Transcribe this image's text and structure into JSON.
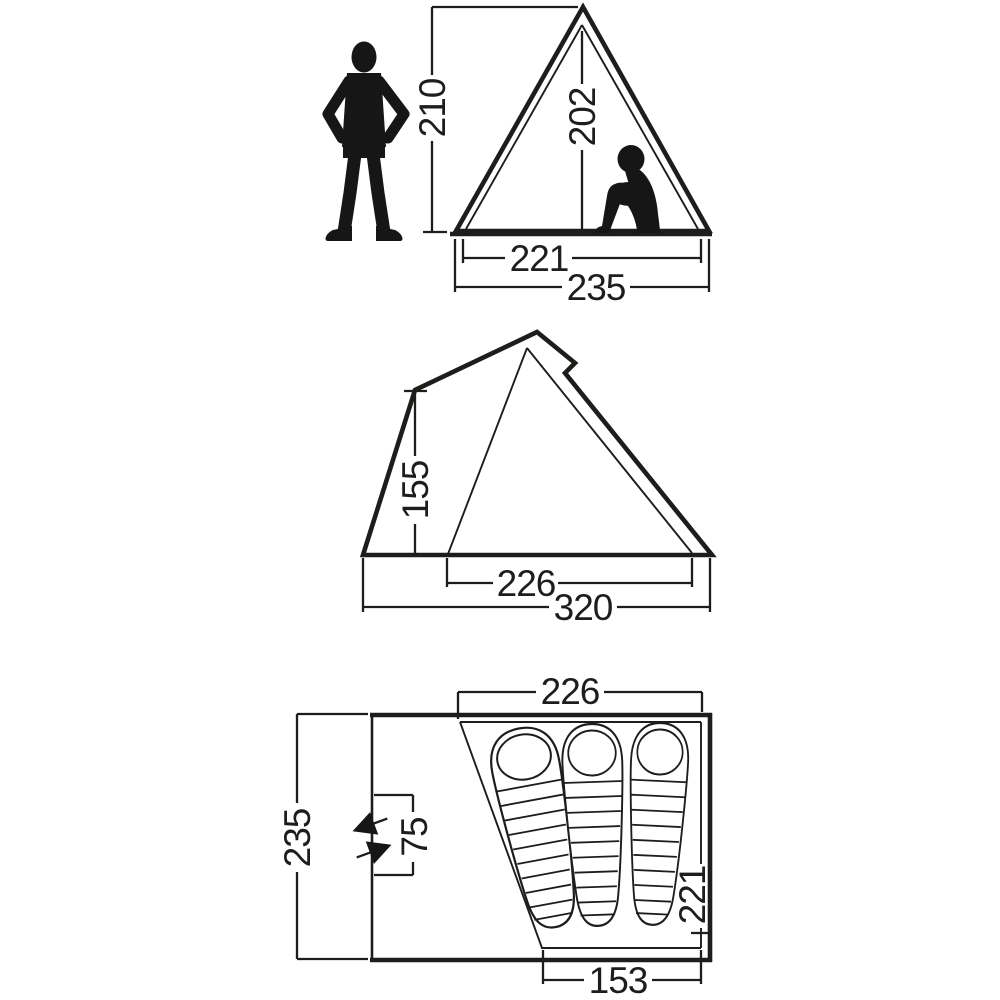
{
  "colors": {
    "background": "#ffffff",
    "line": "#1d1d1b"
  },
  "diagram": {
    "front_view": {
      "standing_height": "210",
      "inner_height": "202",
      "inner_width": "221",
      "outer_width": "235"
    },
    "side_view": {
      "front_height": "155",
      "inner_depth": "226",
      "outer_depth": "320"
    },
    "floor_plan": {
      "inner_width_top": "226",
      "outer_depth": "235",
      "door_width": "75",
      "inner_length": "221",
      "inner_width_bottom": "153"
    }
  }
}
